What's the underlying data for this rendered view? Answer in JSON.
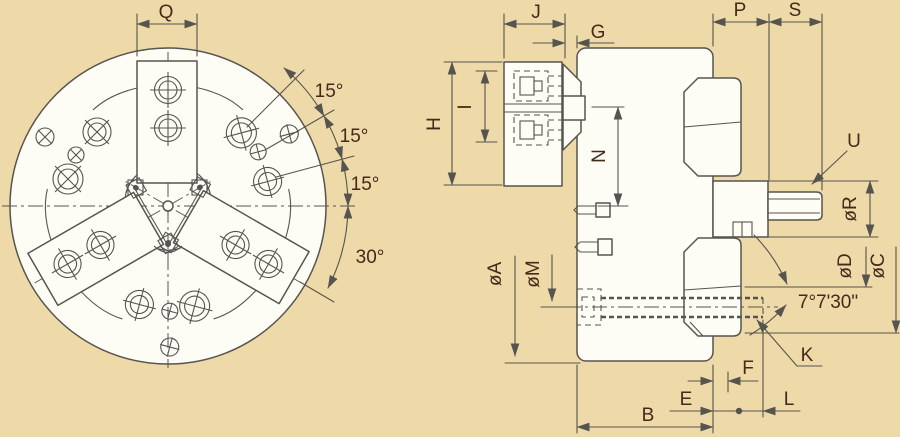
{
  "title": "three-jaw power chuck engineering drawing, front view and cross-section side view",
  "labels": {
    "q": "Q",
    "j": "J",
    "g": "G",
    "p": "P",
    "s": "S",
    "h": "H",
    "i": "I",
    "n": "N",
    "u": "U",
    "dia_r": "øR",
    "dia_d": "øD",
    "dia_c": "øC",
    "dia_a": "øA",
    "dia_m": "øM",
    "taper_angle": "7°7'30\"",
    "k": "K",
    "f": "F",
    "e": "E",
    "b": "B",
    "l": "L",
    "angle_15_1": "15°",
    "angle_15_2": "15°",
    "angle_15_3": "15°",
    "angle_30": "30°"
  },
  "colors": {
    "background": "#eed9a8",
    "line": "#56544e",
    "label_text": "#45291a",
    "surface": "#fdfcf5"
  }
}
